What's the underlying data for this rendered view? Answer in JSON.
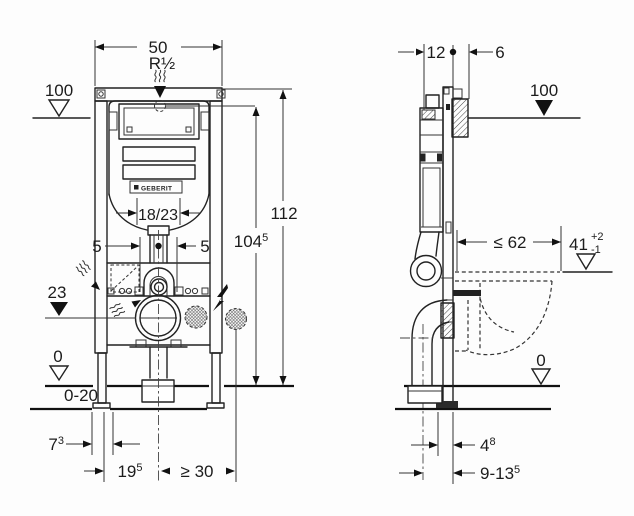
{
  "drawing": {
    "brand": "GEBERIT",
    "front_view": {
      "dim_width": "50",
      "water_connection": "R½",
      "level_100": "100",
      "dim_height_total": "112",
      "dim_height_conn": {
        "base": "104",
        "sup": "5"
      },
      "dim_plate": "18/23",
      "dim_offset_left": "5",
      "dim_offset_right": "5",
      "level_23": "23",
      "level_0": "0",
      "dim_floor_range": "0-20",
      "dim_leg": {
        "base": "7",
        "sup": "3"
      },
      "dim_center_left": {
        "base": "19",
        "sup": "5"
      },
      "dim_side_min": "≥ 30"
    },
    "side_view": {
      "dim_depth_frame": "12",
      "dim_depth_conn": "6",
      "level_100": "100",
      "dim_max_62": "≤ 62",
      "dim_rim": {
        "base": "41",
        "sup": "+2",
        "sub": "-1"
      },
      "level_0": "0",
      "dim_4_8": {
        "base": "4",
        "sup": "8"
      },
      "dim_9_13_5": {
        "base": "9-13",
        "sup": "5"
      }
    }
  }
}
